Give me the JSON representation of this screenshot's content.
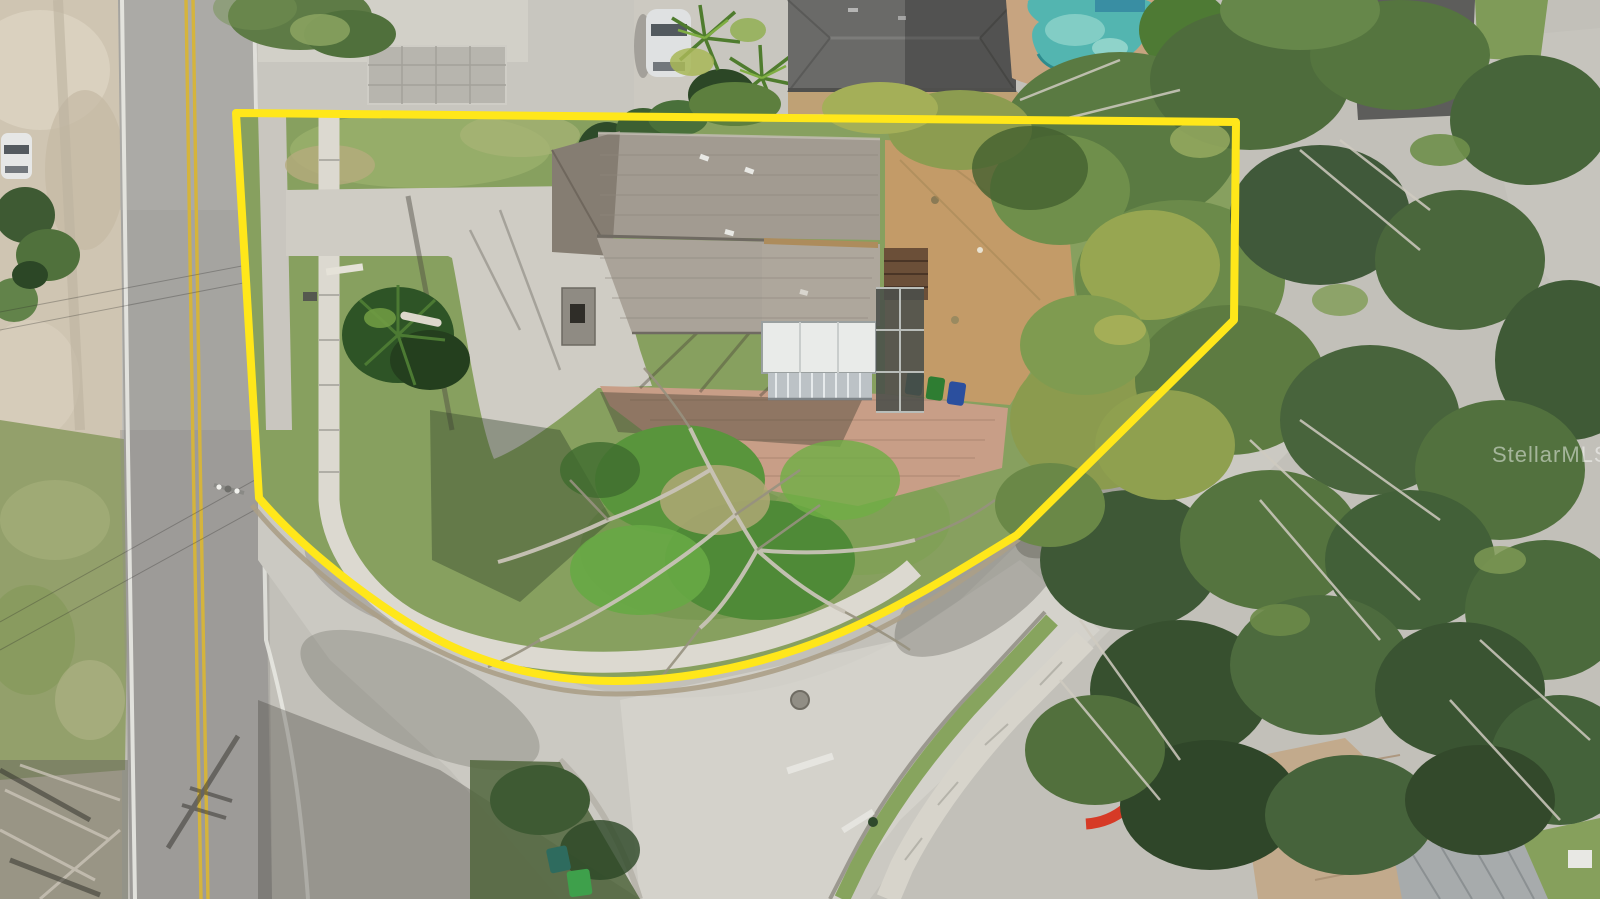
{
  "watermark": {
    "text": "StellarMLS"
  },
  "colors": {
    "property_boundary": "#FFE71A",
    "pool_water": "#53B5B0",
    "main_road_asphalt": "#A5A4A0",
    "side_street_concrete": "#CBC9C2",
    "lot_lawn": "#87A05F",
    "house_roof": "#A29B91",
    "house_roof_lower": "#AAA399",
    "neighbor_roof_dark": "#6A6A68",
    "paver_courtyard": "#C89E87",
    "backyard_dirt": "#C39B68",
    "left_shoulder_dirt": "#CFC5B2",
    "road_centerline_yellow": "#D5B43C",
    "playground_red": "#D63A26",
    "porch_roof_white": "#E9EBE9",
    "pool_deck_sand": "#C7A480"
  }
}
